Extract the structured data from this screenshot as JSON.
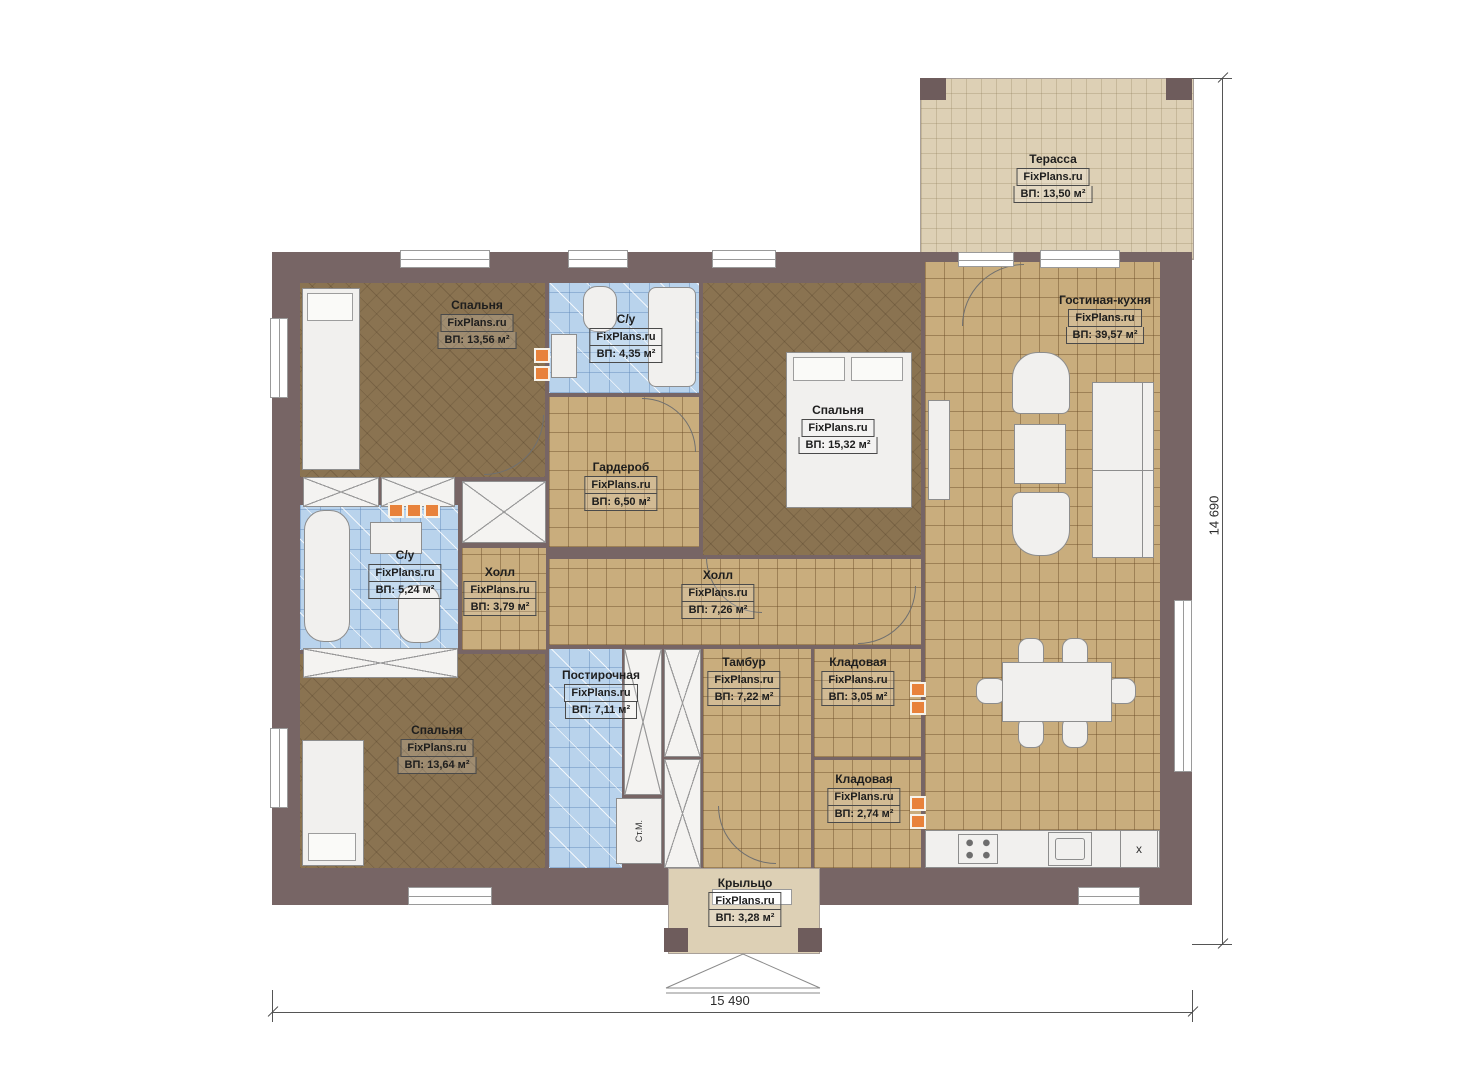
{
  "watermark": "FixPlans.ru",
  "rooms": [
    {
      "name": "Терасса",
      "area": "ВП: 13,50 м²"
    },
    {
      "name": "Спальня",
      "area": "ВП: 13,56 м²"
    },
    {
      "name": "С/у",
      "area": "ВП: 4,35 м²"
    },
    {
      "name": "Гостиная-кухня",
      "area": "ВП: 39,57 м²"
    },
    {
      "name": "Спальня",
      "area": "ВП: 15,32 м²"
    },
    {
      "name": "Гардероб",
      "area": "ВП: 6,50 м²"
    },
    {
      "name": "С/у",
      "area": "ВП: 5,24 м²"
    },
    {
      "name": "Холл",
      "area": "ВП: 3,79 м²"
    },
    {
      "name": "Холл",
      "area": "ВП: 7,26 м²"
    },
    {
      "name": "Спальня",
      "area": "ВП: 13,64 м²"
    },
    {
      "name": "Постирочная",
      "area": "ВП: 7,11 м²"
    },
    {
      "name": "Тамбур",
      "area": "ВП: 7,22 м²"
    },
    {
      "name": "Кладовая",
      "area": "ВП: 3,05 м²"
    },
    {
      "name": "Кладовая",
      "area": "ВП: 2,74 м²"
    },
    {
      "name": "Крыльцо",
      "area": "ВП: 3,28 м²"
    }
  ],
  "dimensions": {
    "bottom": "15 490",
    "right": "14 690"
  },
  "annotations": {
    "washing_machine": "Ст.М.",
    "appliance_x": "x"
  },
  "colors": {
    "wall": "#776565",
    "floor_wood": "#8a7351",
    "floor_tile": "#c9ad7d",
    "floor_bath": "#b9d3ec",
    "floor_terrace": "#ddd0b5",
    "vent": "#e8823b"
  }
}
